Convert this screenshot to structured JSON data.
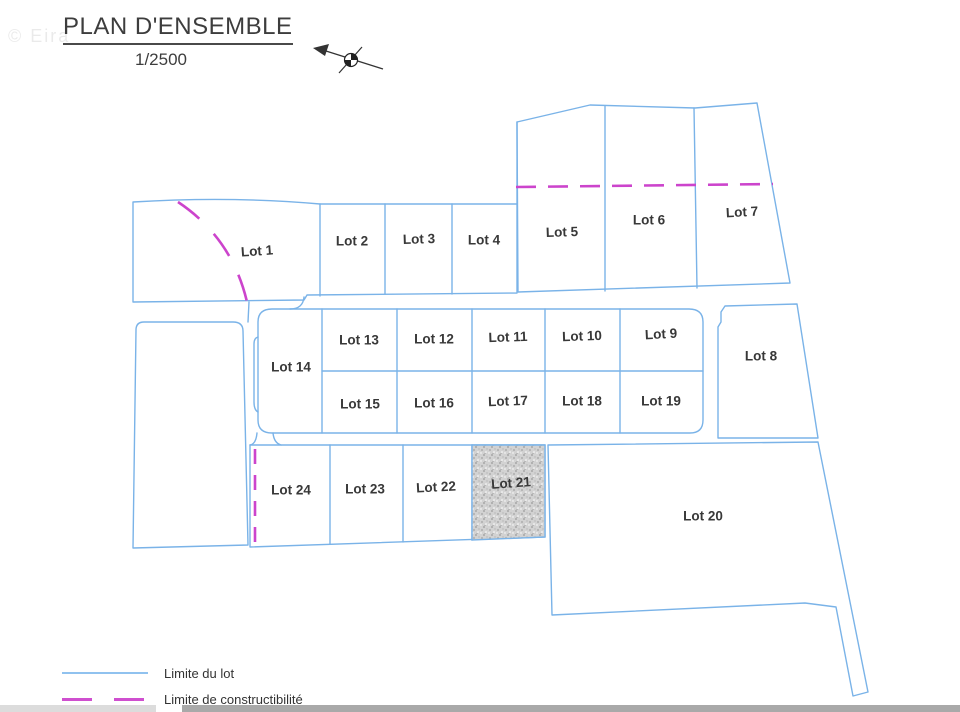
{
  "watermark": "© Eira",
  "header": {
    "title": "PLAN D'ENSEMBLE",
    "scale": "1/2500"
  },
  "plan": {
    "north_arrow_icon": "north-arrow-icon",
    "lots": [
      {
        "id": 1,
        "label": "Lot 1"
      },
      {
        "id": 2,
        "label": "Lot 2"
      },
      {
        "id": 3,
        "label": "Lot 3"
      },
      {
        "id": 4,
        "label": "Lot 4"
      },
      {
        "id": 5,
        "label": "Lot 5"
      },
      {
        "id": 6,
        "label": "Lot 6"
      },
      {
        "id": 7,
        "label": "Lot 7"
      },
      {
        "id": 8,
        "label": "Lot 8"
      },
      {
        "id": 9,
        "label": "Lot 9"
      },
      {
        "id": 10,
        "label": "Lot 10"
      },
      {
        "id": 11,
        "label": "Lot 11"
      },
      {
        "id": 12,
        "label": "Lot 12"
      },
      {
        "id": 13,
        "label": "Lot 13"
      },
      {
        "id": 14,
        "label": "Lot 14"
      },
      {
        "id": 15,
        "label": "Lot 15"
      },
      {
        "id": 16,
        "label": "Lot 16"
      },
      {
        "id": 17,
        "label": "Lot 17"
      },
      {
        "id": 18,
        "label": "Lot 18"
      },
      {
        "id": 19,
        "label": "Lot 19"
      },
      {
        "id": 20,
        "label": "Lot 20"
      },
      {
        "id": 21,
        "label": "Lot 21",
        "hatched": true
      },
      {
        "id": 22,
        "label": "Lot 22"
      },
      {
        "id": 23,
        "label": "Lot 23"
      },
      {
        "id": 24,
        "label": "Lot 24"
      }
    ],
    "constructibility_limits": [
      "dashed arc through Lot 1",
      "horizontal dashed line across Lots 5-7",
      "vertical dashed line at left edge of Lot 24"
    ]
  },
  "legend": {
    "items": [
      {
        "swatch": "solid-blue-line",
        "label": "Limite du lot"
      },
      {
        "swatch": "dashed-magenta-line",
        "label": "Limite de constructibilité"
      }
    ]
  },
  "colors": {
    "lot_boundary_blue": "#7ab3e8",
    "constructibility_magenta": "#cc44cc",
    "label_text": "#383838",
    "lot21_fill": "#d2d2d2",
    "scrollbar_track": "#dcdcdc",
    "scrollbar_thumb": "#a9a9a9"
  }
}
